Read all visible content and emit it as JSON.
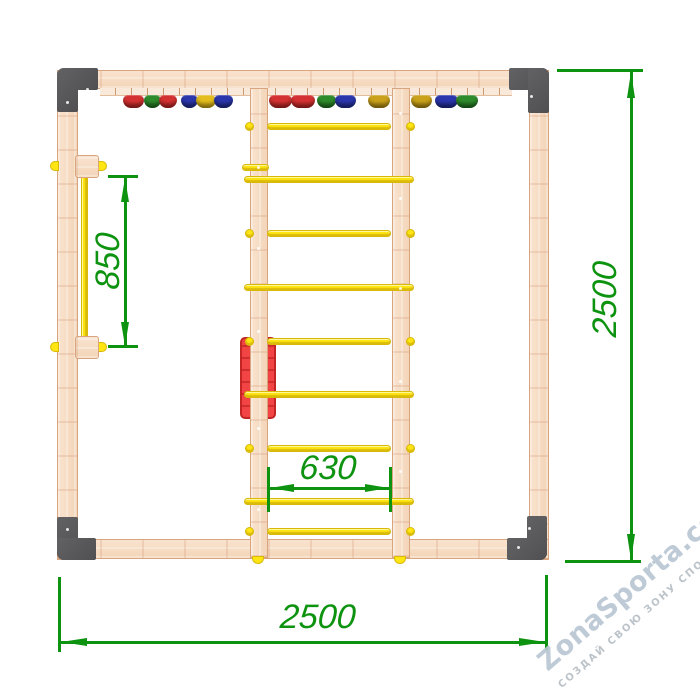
{
  "dimensions": {
    "overall_width": {
      "label": "2500",
      "orientation": "horizontal",
      "position": "bottom"
    },
    "overall_height": {
      "label": "2500",
      "orientation": "vertical",
      "position": "right"
    },
    "bar_length": {
      "label": "850",
      "orientation": "vertical",
      "position": "left-inside"
    },
    "ladder_width": {
      "label": "630",
      "orientation": "horizontal",
      "position": "center-inside"
    }
  },
  "watermark": {
    "brand": "ZonaSporta.com",
    "tagline": "СОЗДАЙ СВОЮ ЗОНУ СПОРТА"
  },
  "colors": {
    "dimension_green": "#0e9310",
    "wood": "#f6dbc2",
    "wood_edge": "#d8a57f",
    "bracket_gray": "#58585a",
    "rung_yellow": "#ffe512",
    "panel_red": "#f24444",
    "panel_red_border": "#c32525",
    "watermark_gray": "#b9c6d3"
  },
  "drawing": {
    "hold_palette": {
      "red": {
        "c": "#d43232",
        "d": "#9c1e1e"
      },
      "green": {
        "c": "#2e8b2b",
        "d": "#1b5f1a"
      },
      "blue": {
        "c": "#2b36ac",
        "d": "#1a2579"
      },
      "yellow": {
        "c": "#e2bd1d",
        "d": "#ad8c10"
      },
      "gold": {
        "c": "#c9a11b",
        "d": "#96760e"
      }
    },
    "holds": [
      {
        "x": 123,
        "w": 21,
        "color": "red"
      },
      {
        "x": 144,
        "w": 17,
        "color": "green"
      },
      {
        "x": 159,
        "w": 18,
        "color": "red"
      },
      {
        "x": 181,
        "w": 17,
        "color": "blue"
      },
      {
        "x": 196,
        "w": 20,
        "color": "yellow"
      },
      {
        "x": 214,
        "w": 19,
        "color": "blue"
      },
      {
        "x": 269,
        "w": 23,
        "color": "red"
      },
      {
        "x": 291,
        "w": 24,
        "color": "red"
      },
      {
        "x": 317,
        "w": 19,
        "color": "green"
      },
      {
        "x": 335,
        "w": 21,
        "color": "blue"
      },
      {
        "x": 368,
        "w": 22,
        "color": "gold"
      },
      {
        "x": 411,
        "w": 21,
        "color": "gold"
      },
      {
        "x": 435,
        "w": 23,
        "color": "blue"
      },
      {
        "x": 456,
        "w": 22,
        "color": "green"
      }
    ],
    "rungs": [
      {
        "y": 123,
        "bar": [
          267,
          124
        ],
        "caps": [
          245,
          406
        ]
      },
      {
        "y": 164,
        "bar": [
          242,
          27
        ],
        "caps": null
      },
      {
        "y": 176,
        "bar": [
          244,
          170
        ],
        "caps": null
      },
      {
        "y": 230,
        "bar": [
          267,
          124
        ],
        "caps": [
          245,
          406
        ]
      },
      {
        "y": 284,
        "bar": [
          244,
          170
        ],
        "caps": null
      },
      {
        "y": 338,
        "bar": [
          267,
          124
        ],
        "caps": [
          245,
          406
        ]
      },
      {
        "y": 391,
        "bar": [
          244,
          170
        ],
        "caps": null
      },
      {
        "y": 445,
        "bar": [
          267,
          124
        ],
        "caps": [
          245,
          406
        ]
      },
      {
        "y": 498,
        "bar": [
          244,
          170
        ],
        "caps": null
      },
      {
        "y": 528,
        "bar": [
          267,
          124
        ],
        "caps": [
          245,
          406
        ]
      }
    ],
    "screws": [
      {
        "x": 257,
        "y": 166
      },
      {
        "x": 257,
        "y": 247
      },
      {
        "x": 257,
        "y": 330
      },
      {
        "x": 257,
        "y": 427
      },
      {
        "x": 257,
        "y": 508
      },
      {
        "x": 399,
        "y": 112
      },
      {
        "x": 399,
        "y": 197
      },
      {
        "x": 399,
        "y": 287
      },
      {
        "x": 399,
        "y": 380
      },
      {
        "x": 399,
        "y": 470
      },
      {
        "x": 86,
        "y": 88
      },
      {
        "x": 66,
        "y": 101
      },
      {
        "x": 530,
        "y": 95
      },
      {
        "x": 66,
        "y": 528
      },
      {
        "x": 528,
        "y": 527
      },
      {
        "x": 517,
        "y": 546
      }
    ]
  }
}
